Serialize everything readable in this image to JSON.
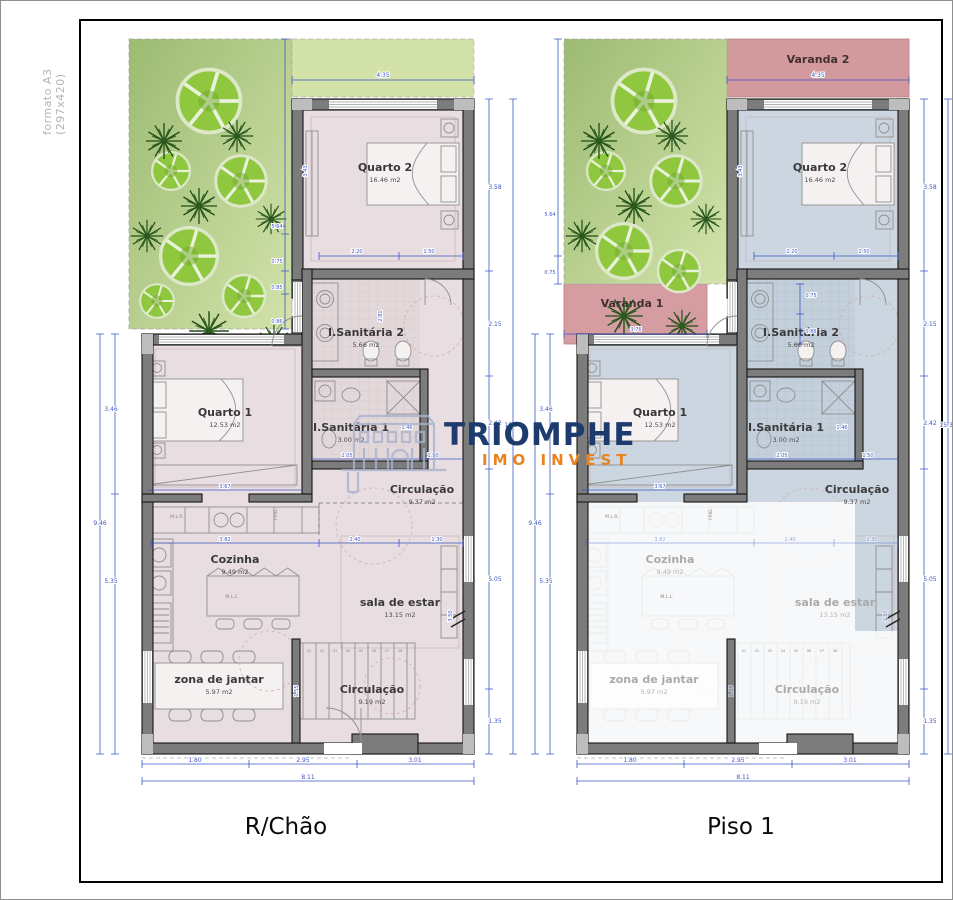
{
  "page": {
    "format_label": "formato A3 (297x420)",
    "title_left": "R/Chão",
    "title_right": "Piso 1"
  },
  "logo": {
    "name": "TRIOMPHE",
    "subtitle": "IMO INVEST",
    "navy": "#1d3c6d",
    "orange": "#e8831d"
  },
  "colors": {
    "floor_left": "#e8dde0",
    "floor_right": "#cbd6e1",
    "varanda": "#d39a9e",
    "garden_dark": "#a3c17a",
    "garden_light": "#d3e3ab",
    "dimension_blue": "#3f57c6",
    "wall_gray": "#7c7c7c"
  },
  "rooms": {
    "q2": {
      "name": "Quarto 2",
      "area": "16.46 m2"
    },
    "is2": {
      "name": "I.Sanitária 2",
      "area": "5.66 m2"
    },
    "q1": {
      "name": "Quarto 1",
      "area": "12.53 m2"
    },
    "is1": {
      "name": "I.Sanitária 1",
      "area": "3.00 m2"
    },
    "circ": {
      "name": "Circulação",
      "area": "9.37 m2"
    },
    "coz": {
      "name": "Cozinha",
      "area": "9.49 m2"
    },
    "sala": {
      "name": "sala de estar",
      "area": "13.15 m2"
    },
    "jantar": {
      "name": "zona de jantar",
      "area": "5.97 m2"
    },
    "circ2": {
      "name": "Circulação",
      "area": "9.19 m2"
    }
  },
  "varandas": {
    "v1": "Varanda 1",
    "v2": "Varanda 2"
  },
  "kitchen": {
    "mlr": "M.L.R.",
    "frig": "FRIG.",
    "mll": "M.L.L."
  },
  "dims": {
    "top": "4.35",
    "garden": [
      "5.64",
      "0.75",
      "0.85",
      "0.86"
    ],
    "wall_q2": "3.43",
    "right": [
      "3.58",
      "2.15",
      "2.42",
      "5.05",
      "1.35"
    ],
    "right_total": "15.30",
    "left": [
      "3.46",
      "5.35"
    ],
    "left_total": "9.46",
    "bottom": [
      "1.80",
      "2.95",
      "3.01"
    ],
    "bottom_total": "8.11",
    "q2_bottom": [
      "2.20",
      "1.50"
    ],
    "is2_side": "2.81",
    "q1_width": "3.67",
    "is1_row": [
      "2.05",
      "1.50"
    ],
    "is1_side": "1.46",
    "coz_width": "3.82",
    "sala_row": [
      "2.40",
      "1.30"
    ],
    "sala_side": "3.50",
    "stair_side": "1.55",
    "varanda1_width": "3.76",
    "varanda1_side": [
      "0.75",
      "0.86"
    ]
  },
  "stairs": [
    "01",
    "02",
    "03",
    "04",
    "05",
    "06",
    "07",
    "08",
    "09"
  ]
}
